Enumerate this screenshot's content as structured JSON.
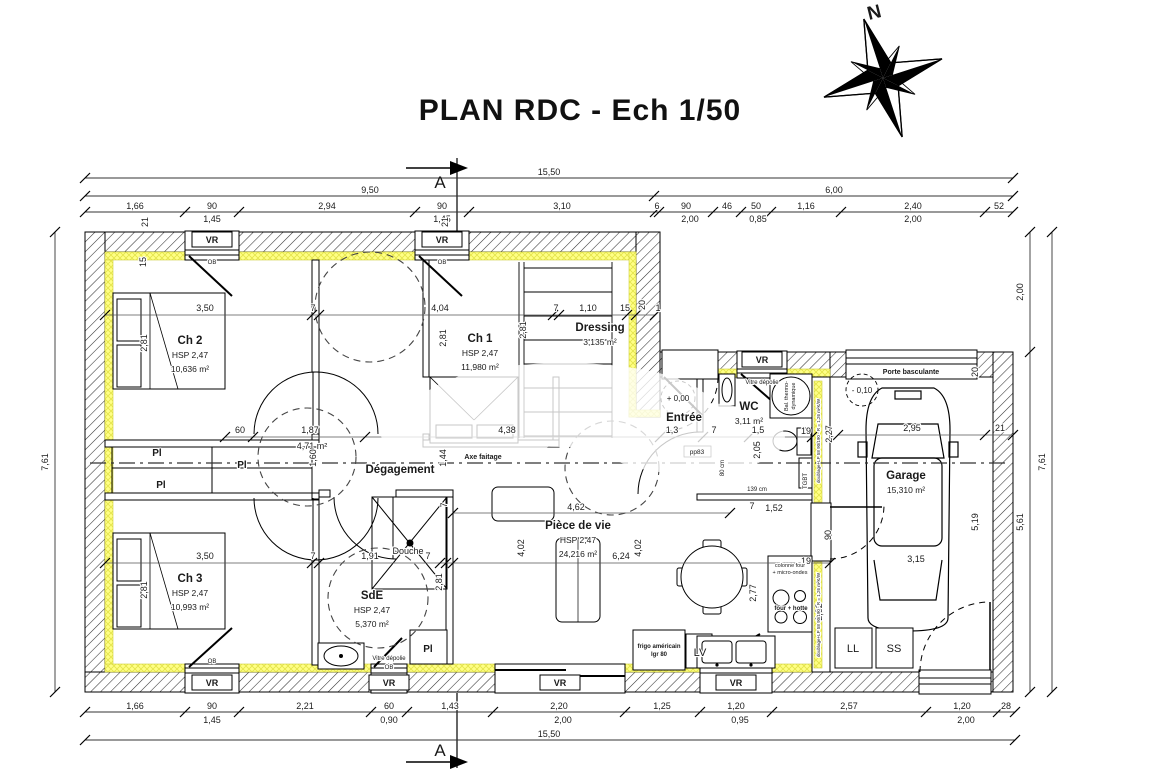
{
  "title": "PLAN RDC - Ech 1/50",
  "north_label": "N",
  "section_marker": "A",
  "colors": {
    "insulation": "#ffff85",
    "wall": "#000000",
    "background": "#ffffff"
  },
  "rooms": [
    {
      "name": "Ch 2",
      "hsp": "HSP 2,47",
      "area": "10,636 m²",
      "x": 190,
      "y": 344
    },
    {
      "name": "Ch 1",
      "hsp": "HSP 2,47",
      "area": "11,980 m²",
      "x": 480,
      "y": 342
    },
    {
      "name": "Dressing",
      "area": "3,135 m²",
      "x": 600,
      "y": 331
    },
    {
      "name": "WC",
      "area": "3,11 m²",
      "x": 749,
      "y": 410
    },
    {
      "name": "Entrée",
      "x": 684,
      "y": 421
    },
    {
      "name": "Dégagement",
      "x": 400,
      "y": 473
    },
    {
      "name": "Ch 3",
      "hsp": "HSP 2,47",
      "area": "10,993 m²",
      "x": 190,
      "y": 582
    },
    {
      "name": "SdE",
      "hsp": "HSP 2,47",
      "area": "5,370 m²",
      "x": 372,
      "y": 599
    },
    {
      "name": "Pièce de vie",
      "hsp": "HSP 2,47",
      "area": "24,216 m²",
      "x": 578,
      "y": 529
    },
    {
      "name": "Garage",
      "area": "15,310 m²",
      "x": 906,
      "y": 479
    }
  ],
  "dim_labels": [
    {
      "x": 549,
      "y": 175,
      "t": "15,50"
    },
    {
      "x": 370,
      "y": 193,
      "t": "9,50"
    },
    {
      "x": 834,
      "y": 193,
      "t": "6,00"
    },
    {
      "x": 135,
      "y": 209,
      "t": "1,66"
    },
    {
      "x": 212,
      "y": 209,
      "t": "90"
    },
    {
      "x": 212,
      "y": 222,
      "t": "1,45"
    },
    {
      "x": 327,
      "y": 209,
      "t": "2,94"
    },
    {
      "x": 442,
      "y": 209,
      "t": "90"
    },
    {
      "x": 442,
      "y": 222,
      "t": "1,45"
    },
    {
      "x": 562,
      "y": 209,
      "t": "3,10"
    },
    {
      "x": 657,
      "y": 209,
      "t": "6"
    },
    {
      "x": 686,
      "y": 209,
      "t": "90"
    },
    {
      "x": 690,
      "y": 222,
      "t": "2,00"
    },
    {
      "x": 727,
      "y": 209,
      "t": "46"
    },
    {
      "x": 756,
      "y": 209,
      "t": "50"
    },
    {
      "x": 758,
      "y": 222,
      "t": "0,85"
    },
    {
      "x": 806,
      "y": 209,
      "t": "1,16"
    },
    {
      "x": 913,
      "y": 209,
      "t": "2,40"
    },
    {
      "x": 913,
      "y": 222,
      "t": "2,00"
    },
    {
      "x": 999,
      "y": 209,
      "t": "52"
    },
    {
      "x": 135,
      "y": 709,
      "t": "1,66"
    },
    {
      "x": 212,
      "y": 709,
      "t": "90"
    },
    {
      "x": 212,
      "y": 723,
      "t": "1,45"
    },
    {
      "x": 305,
      "y": 709,
      "t": "2,21"
    },
    {
      "x": 389,
      "y": 709,
      "t": "60"
    },
    {
      "x": 389,
      "y": 723,
      "t": "0,90"
    },
    {
      "x": 450,
      "y": 709,
      "t": "1,43"
    },
    {
      "x": 559,
      "y": 709,
      "t": "2,20"
    },
    {
      "x": 563,
      "y": 723,
      "t": "2,00"
    },
    {
      "x": 662,
      "y": 709,
      "t": "1,25"
    },
    {
      "x": 736,
      "y": 709,
      "t": "1,20"
    },
    {
      "x": 740,
      "y": 723,
      "t": "0,95"
    },
    {
      "x": 849,
      "y": 709,
      "t": "2,57"
    },
    {
      "x": 962,
      "y": 709,
      "t": "1,20"
    },
    {
      "x": 966,
      "y": 723,
      "t": "2,00"
    },
    {
      "x": 1006,
      "y": 709,
      "t": "28"
    },
    {
      "x": 549,
      "y": 737,
      "t": "15,50"
    },
    {
      "x": 48,
      "y": 462,
      "t": "7,61",
      "r": -90
    },
    {
      "x": 1023,
      "y": 292,
      "t": "2,00",
      "r": -90
    },
    {
      "x": 1023,
      "y": 522,
      "t": "5,61",
      "r": -90
    },
    {
      "x": 1045,
      "y": 462,
      "t": "7,61",
      "r": -90
    },
    {
      "x": 205,
      "y": 311,
      "t": "3,50"
    },
    {
      "x": 313,
      "y": 311,
      "t": "7"
    },
    {
      "x": 440,
      "y": 311,
      "t": "4,04"
    },
    {
      "x": 556,
      "y": 311,
      "t": "7"
    },
    {
      "x": 588,
      "y": 311,
      "t": "1,10"
    },
    {
      "x": 625,
      "y": 311,
      "t": "15"
    },
    {
      "x": 645,
      "y": 305,
      "t": "20",
      "r": -90
    },
    {
      "x": 658,
      "y": 311,
      "t": "1"
    },
    {
      "x": 147,
      "y": 343,
      "t": "2,81",
      "r": -90
    },
    {
      "x": 446,
      "y": 338,
      "t": "2,81",
      "r": -90
    },
    {
      "x": 526,
      "y": 330,
      "t": "2,81",
      "r": -90
    },
    {
      "x": 146,
      "y": 262,
      "t": "15",
      "r": -90
    },
    {
      "x": 148,
      "y": 222,
      "t": "21",
      "r": -90
    },
    {
      "x": 448,
      "y": 222,
      "t": "21",
      "r": -90
    },
    {
      "x": 205,
      "y": 559,
      "t": "3,50"
    },
    {
      "x": 313,
      "y": 559,
      "t": "7"
    },
    {
      "x": 370,
      "y": 559,
      "t": "1,91"
    },
    {
      "x": 428,
      "y": 559,
      "t": "7"
    },
    {
      "x": 442,
      "y": 582,
      "t": "2,81",
      "r": -90
    },
    {
      "x": 147,
      "y": 590,
      "t": "2,81",
      "r": -90
    },
    {
      "x": 447,
      "y": 505,
      "t": "7",
      "r": -90
    },
    {
      "x": 240,
      "y": 433,
      "t": "60"
    },
    {
      "x": 310,
      "y": 433,
      "t": "1,87"
    },
    {
      "x": 312,
      "y": 449,
      "t": "4,71 m²"
    },
    {
      "x": 316,
      "y": 458,
      "t": "1,60",
      "r": -90
    },
    {
      "x": 446,
      "y": 458,
      "t": "1,44",
      "r": -90
    },
    {
      "x": 507,
      "y": 433,
      "t": "4,38"
    },
    {
      "x": 672,
      "y": 433,
      "t": "1,3"
    },
    {
      "x": 714,
      "y": 433,
      "t": "7"
    },
    {
      "x": 758,
      "y": 433,
      "t": "1,5"
    },
    {
      "x": 806,
      "y": 434,
      "t": "19"
    },
    {
      "x": 760,
      "y": 450,
      "t": "2,05",
      "r": -90
    },
    {
      "x": 832,
      "y": 434,
      "t": "2,27",
      "r": -90
    },
    {
      "x": 752,
      "y": 509,
      "t": "7"
    },
    {
      "x": 774,
      "y": 511,
      "t": "1,52"
    },
    {
      "x": 576,
      "y": 510,
      "t": "4,62"
    },
    {
      "x": 524,
      "y": 548,
      "t": "4,02",
      "r": -90
    },
    {
      "x": 641,
      "y": 548,
      "t": "4,02",
      "r": -90
    },
    {
      "x": 621,
      "y": 559,
      "t": "6,24"
    },
    {
      "x": 756,
      "y": 593,
      "t": "2,77",
      "r": -90
    },
    {
      "x": 912,
      "y": 431,
      "t": "2,95"
    },
    {
      "x": 1000,
      "y": 431,
      "t": "21"
    },
    {
      "x": 978,
      "y": 372,
      "t": "20",
      "r": -90
    },
    {
      "x": 831,
      "y": 535,
      "t": "90",
      "r": -90
    },
    {
      "x": 822,
      "y": 612,
      "t": "2,02",
      "r": -90
    },
    {
      "x": 978,
      "y": 522,
      "t": "5,19",
      "r": -90
    },
    {
      "x": 916,
      "y": 562,
      "t": "3,15"
    },
    {
      "x": 806,
      "y": 564,
      "t": "19"
    },
    {
      "x": 724,
      "y": 468,
      "t": "80 cm",
      "r": -90,
      "fs": 6
    },
    {
      "x": 757,
      "y": 491,
      "t": "139 cm",
      "fs": 6
    }
  ],
  "feature_labels": [
    {
      "x": 212,
      "y": 243,
      "t": "VR",
      "b": 1
    },
    {
      "x": 442,
      "y": 243,
      "t": "VR",
      "b": 1
    },
    {
      "x": 762,
      "y": 363,
      "t": "VR",
      "b": 1
    },
    {
      "x": 212,
      "y": 686,
      "t": "VR",
      "b": 1
    },
    {
      "x": 389,
      "y": 686,
      "t": "VR",
      "b": 1
    },
    {
      "x": 560,
      "y": 686,
      "t": "VR",
      "b": 1
    },
    {
      "x": 736,
      "y": 686,
      "t": "VR",
      "b": 1
    },
    {
      "x": 212,
      "y": 264,
      "t": "OB",
      "fs": 6
    },
    {
      "x": 442,
      "y": 264,
      "t": "OB",
      "fs": 6
    },
    {
      "x": 212,
      "y": 663,
      "t": "OB",
      "fs": 6
    },
    {
      "x": 389,
      "y": 669,
      "t": "OB",
      "fs": 6
    },
    {
      "x": 762,
      "y": 384,
      "t": "Vitre dépolie",
      "fs": 6
    },
    {
      "x": 389,
      "y": 660,
      "t": "Vitre dépolie",
      "fs": 6
    },
    {
      "x": 911,
      "y": 374,
      "t": "Porte basculante",
      "fs": 7,
      "b": 1
    },
    {
      "x": 408,
      "y": 554,
      "t": "Douche",
      "fs": 9
    },
    {
      "x": 157,
      "y": 456,
      "t": "Pl",
      "b": 1,
      "fs": 10
    },
    {
      "x": 161,
      "y": 488,
      "t": "Pl",
      "b": 1,
      "fs": 10
    },
    {
      "x": 242,
      "y": 468,
      "t": "Pl",
      "b": 1,
      "fs": 10
    },
    {
      "x": 428,
      "y": 652,
      "t": "Pl",
      "b": 1,
      "fs": 10
    },
    {
      "x": 853,
      "y": 652,
      "t": "LL",
      "fs": 11
    },
    {
      "x": 894,
      "y": 652,
      "t": "SS",
      "fs": 11
    },
    {
      "x": 700,
      "y": 656,
      "t": "LV",
      "fs": 11
    },
    {
      "x": 659,
      "y": 648,
      "t": "frigo américain",
      "fs": 6,
      "b": 1
    },
    {
      "x": 659,
      "y": 656,
      "t": "lgr 80",
      "fs": 6,
      "b": 1
    },
    {
      "x": 790,
      "y": 567,
      "t": "colonne four",
      "fs": 5.5
    },
    {
      "x": 790,
      "y": 574,
      "t": "+ micro-ondes",
      "fs": 5.5
    },
    {
      "x": 791,
      "y": 610,
      "t": "four + hotte",
      "fs": 6,
      "b": 1
    },
    {
      "x": 807,
      "y": 481,
      "t": "TGBT",
      "fs": 6,
      "r": -90
    },
    {
      "x": 697,
      "y": 454,
      "t": "pp83",
      "fs": 6.5
    },
    {
      "x": 483,
      "y": 459,
      "t": "Axe faitage",
      "fs": 7,
      "b": 1
    },
    {
      "x": 678,
      "y": 401,
      "t": "+ 0,00",
      "fs": 8
    },
    {
      "x": 862,
      "y": 393,
      "t": "- 0,10",
      "fs": 8
    },
    {
      "x": 788,
      "y": 396,
      "t": "Bal. thermo-",
      "fs": 5.5,
      "r": -90
    },
    {
      "x": 795,
      "y": 396,
      "t": "dynamique",
      "fs": 5.5,
      "r": -90
    },
    {
      "x": 820,
      "y": 441,
      "t": "doublage+LP 58 90/190 - R = 1,26 m²K/W",
      "fs": 4.5,
      "r": -90
    },
    {
      "x": 820,
      "y": 615,
      "t": "doublage+LP 58 90/190 - R = 1,26 m²K/W",
      "fs": 4.5,
      "r": -90
    }
  ]
}
